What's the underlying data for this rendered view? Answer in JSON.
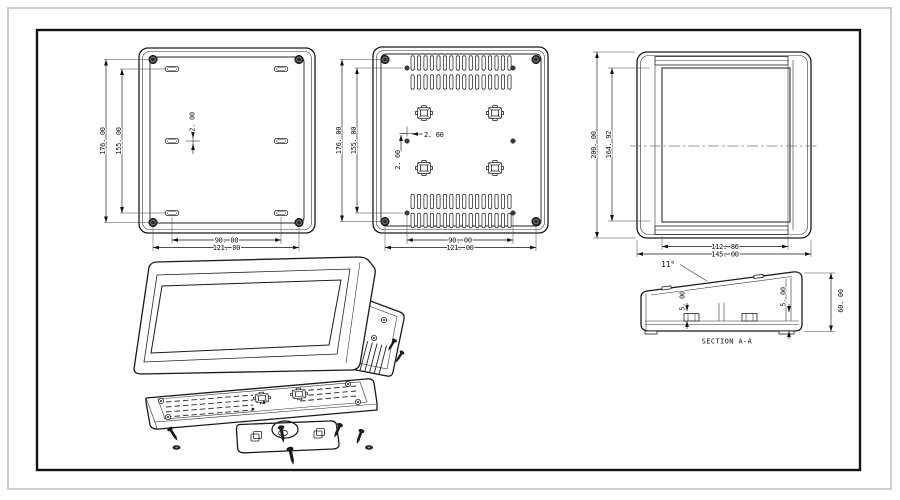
{
  "sheet": {
    "views": {
      "front": {
        "height_outer": "176. 00",
        "height_inner": "155. 00",
        "slot_offset": "2. 00",
        "width_inner": "90. 00",
        "width_outer": "121. 00"
      },
      "back": {
        "height_outer": "176. 00",
        "height_inner": "155. 00",
        "hole_offset_x": "2. 60",
        "hole_offset_y": "2. 60",
        "width_inner": "90. 00",
        "width_outer": "121. 00"
      },
      "side": {
        "height_outer": "200. 00",
        "height_inner": "164. 92",
        "depth_inner": "112. 86",
        "depth_outer": "145. 00"
      },
      "section": {
        "label": "SECTION A-A",
        "top_angle": "11°",
        "boss_height": "5. 00",
        "wall_height": "5. 00",
        "height": "60. 00"
      }
    }
  }
}
